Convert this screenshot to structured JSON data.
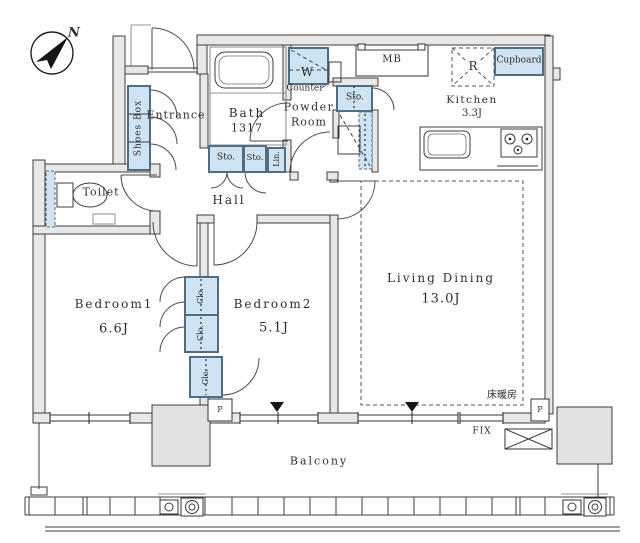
{
  "title": "Apartment floor plan 2LDK",
  "compass": {
    "north_label": "N"
  },
  "rooms": {
    "entrance": {
      "name": "Entrance"
    },
    "toilet": {
      "name": "Toilet"
    },
    "bath": {
      "name": "Bath",
      "size": "1317"
    },
    "powder_room": {
      "line1": "Powder",
      "line2": "Room"
    },
    "hall": {
      "name": "Hall"
    },
    "kitchen": {
      "name": "Kitchen",
      "size": "3.3J"
    },
    "bedroom1": {
      "name": "Bedroom1",
      "size": "6.6J"
    },
    "bedroom2": {
      "name": "Bedroom2",
      "size": "5.1J"
    },
    "living_dining": {
      "name": "Living Dining",
      "size": "13.0J"
    },
    "balcony": {
      "name": "Balcony"
    }
  },
  "fixtures": {
    "shoes_box": "Shoes Box",
    "washing_machine": "W",
    "counter": "Counter",
    "storage": [
      "Sto.",
      "Sto.",
      "Sto."
    ],
    "linen": "Lin.",
    "meter_box": "MB",
    "refrigerator": "R",
    "cupboard": "Cupboard",
    "closets": [
      "Clo.",
      "Clo.",
      "Clo."
    ],
    "floor_heating": "床暖房",
    "fixed_window": "FIX",
    "pipe_spaces": [
      "P",
      "P"
    ]
  },
  "colors": {
    "storage_fill": "#cfe3f2",
    "storage_stroke": "#4d6e84",
    "wall_fill": "#e8e8e8",
    "wall_stroke": "#3c3c3c"
  }
}
